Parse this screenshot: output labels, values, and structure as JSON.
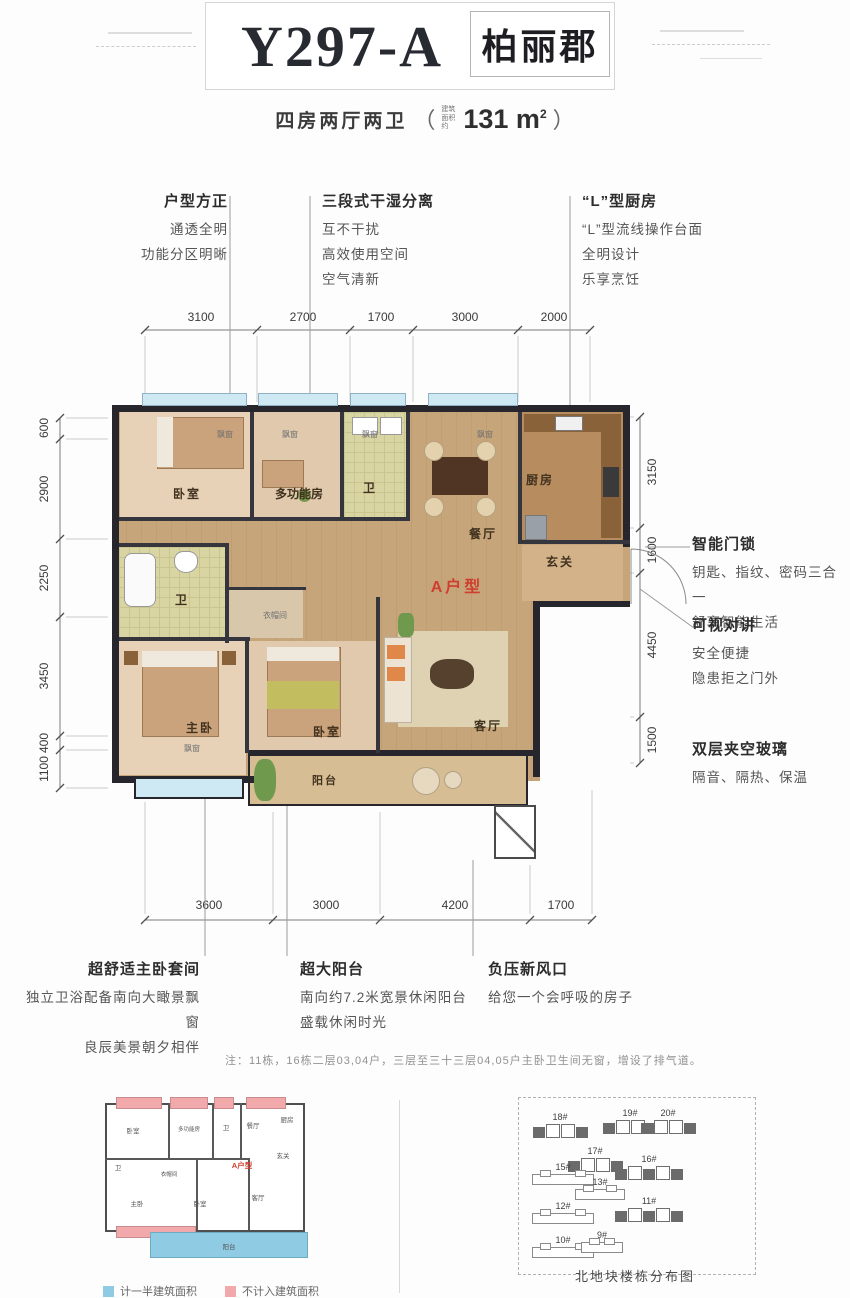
{
  "header": {
    "model": "Y297-A",
    "brand": "柏丽郡",
    "subtitle": "四房两厅两卫",
    "paren_open": "（",
    "area_prefix": "建筑面积约",
    "area_value": "131 m",
    "area_sup": "2",
    "paren_close": "）"
  },
  "features_top": [
    {
      "title": "户型方正",
      "lines": [
        "通透全明",
        "功能分区明晰"
      ]
    },
    {
      "title": "三段式干湿分离",
      "lines": [
        "互不干扰",
        "高效使用空间",
        "空气清新"
      ]
    },
    {
      "title": "“L”型厨房",
      "lines": [
        "“L”型流线操作台面",
        "全明设计",
        "乐享烹饪"
      ]
    }
  ],
  "features_right": [
    {
      "title": "智能门锁",
      "lines": [
        "钥匙、指纹、密码三合一",
        "舒享智能生活"
      ]
    },
    {
      "title": "可视对讲",
      "lines": [
        "安全便捷",
        "隐患拒之门外"
      ]
    },
    {
      "title": "双层夹空玻璃",
      "lines": [
        "隔音、隔热、保温"
      ]
    }
  ],
  "features_bottom": [
    {
      "title": "超舒适主卧套间",
      "lines": [
        "独立卫浴配备南向大瞰景飘窗",
        "良辰美景朝夕相伴"
      ]
    },
    {
      "title": "超大阳台",
      "lines": [
        "南向约7.2米宽景休闲阳台",
        "盛载休闲时光"
      ]
    },
    {
      "title": "负压新风口",
      "lines": [
        "给您一个会呼吸的房子"
      ]
    }
  ],
  "dimensions": {
    "top": [
      "3100",
      "2700",
      "1700",
      "3000",
      "2000"
    ],
    "bottom": [
      "3600",
      "3000",
      "4200",
      "1700"
    ],
    "left": [
      "600",
      "2900",
      "2250",
      "3450",
      "400",
      "1100"
    ],
    "right": [
      "3150",
      "1600",
      "4450",
      "1500"
    ]
  },
  "plan": {
    "unit_label": "A户型",
    "bay_label": "飘窗",
    "rooms": {
      "bedroom2": "卧室",
      "multifunction": "多功能房",
      "bath2": "卫",
      "dining": "餐厅",
      "kitchen": "厨房",
      "foyer": "玄关",
      "bath1": "卫",
      "cloakroom": "衣帽间",
      "master": "主卧",
      "bedroom3": "卧室",
      "living": "客厅",
      "balcony": "阳台"
    }
  },
  "note": "注：11栋，16栋二层03,04户，三层至三十三层04,05户主卧卫生间无窗，增设了排气道。",
  "legend": [
    {
      "label": "计一半建筑面积",
      "color": "#8fcbe3"
    },
    {
      "label": "不计入建筑面积",
      "color": "#f2a9ac"
    }
  ],
  "site_map": {
    "caption": "北地块楼栋分布图",
    "buildings": [
      {
        "id": "18#"
      },
      {
        "id": "17#"
      },
      {
        "id": "19#"
      },
      {
        "id": "20#"
      },
      {
        "id": "15#"
      },
      {
        "id": "16#"
      },
      {
        "id": "13#"
      },
      {
        "id": "12#"
      },
      {
        "id": "11#"
      },
      {
        "id": "10#"
      },
      {
        "id": "9#"
      }
    ]
  },
  "colors": {
    "accent_red": "#cf3e2e",
    "bay_blue": "#cfe9f4",
    "legend_blue": "#8fcbe3",
    "legend_pink": "#f2a9ac",
    "wall_dark": "#26262c"
  }
}
